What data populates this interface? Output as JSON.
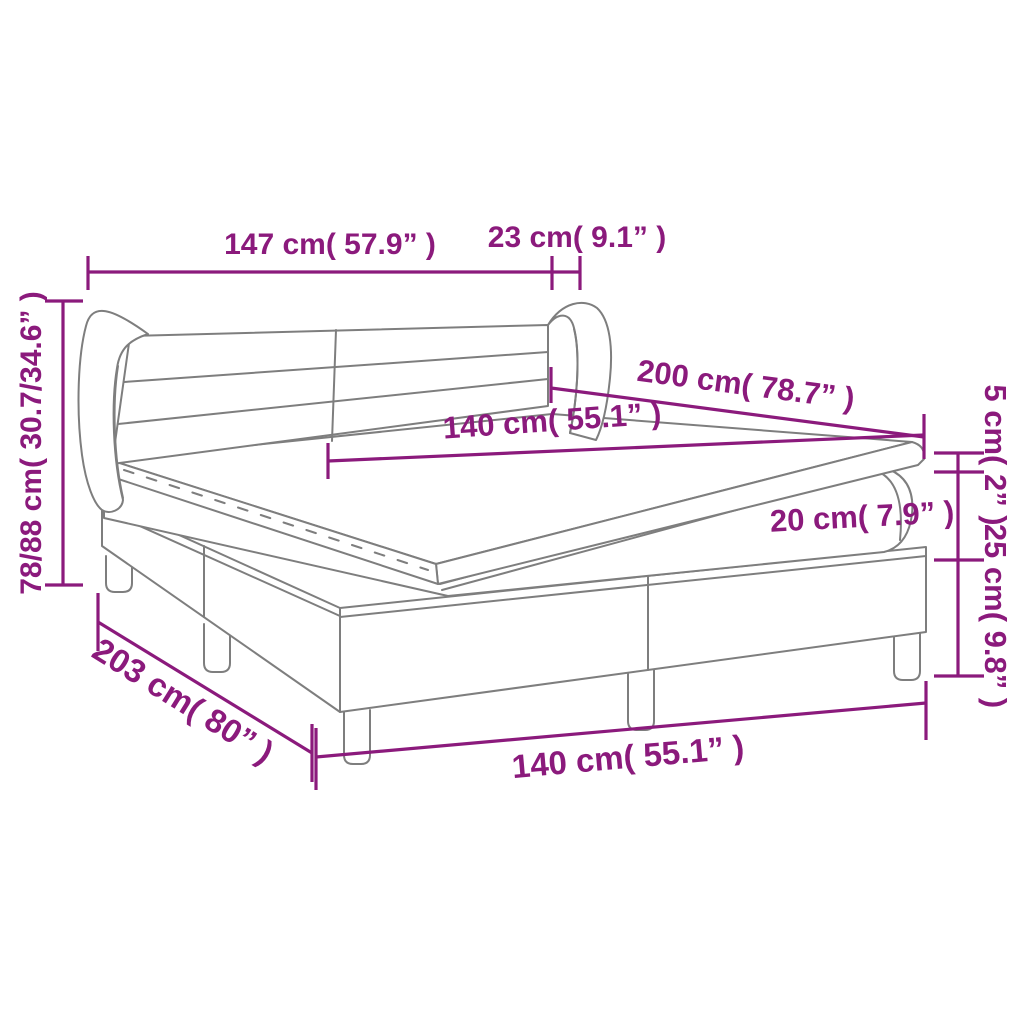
{
  "diagram": {
    "type": "product-dimension-diagram",
    "subject": "box spring bed with winged headboard, mattress and topper",
    "background_color": "#FFFFFF",
    "accent_color": "#8B1A7C",
    "line_color": "#7E7E7E"
  },
  "labels": {
    "headboard_width": "147 cm( 57.9” )",
    "wing_depth": "23 cm( 9.1” )",
    "total_height": "78/88 cm( 30.7/34.6” )",
    "mattress_length": "200 cm( 78.7” )",
    "mattress_width": "140 cm( 55.1” )",
    "topper_thickness": "5 cm( 2” )",
    "mattress_thickness": "20 cm( 7.9” )",
    "base_with_legs_height": "25 cm( 9.8” )",
    "bed_length": "203 cm( 80” )",
    "bed_width": "140 cm( 55.1” )"
  }
}
